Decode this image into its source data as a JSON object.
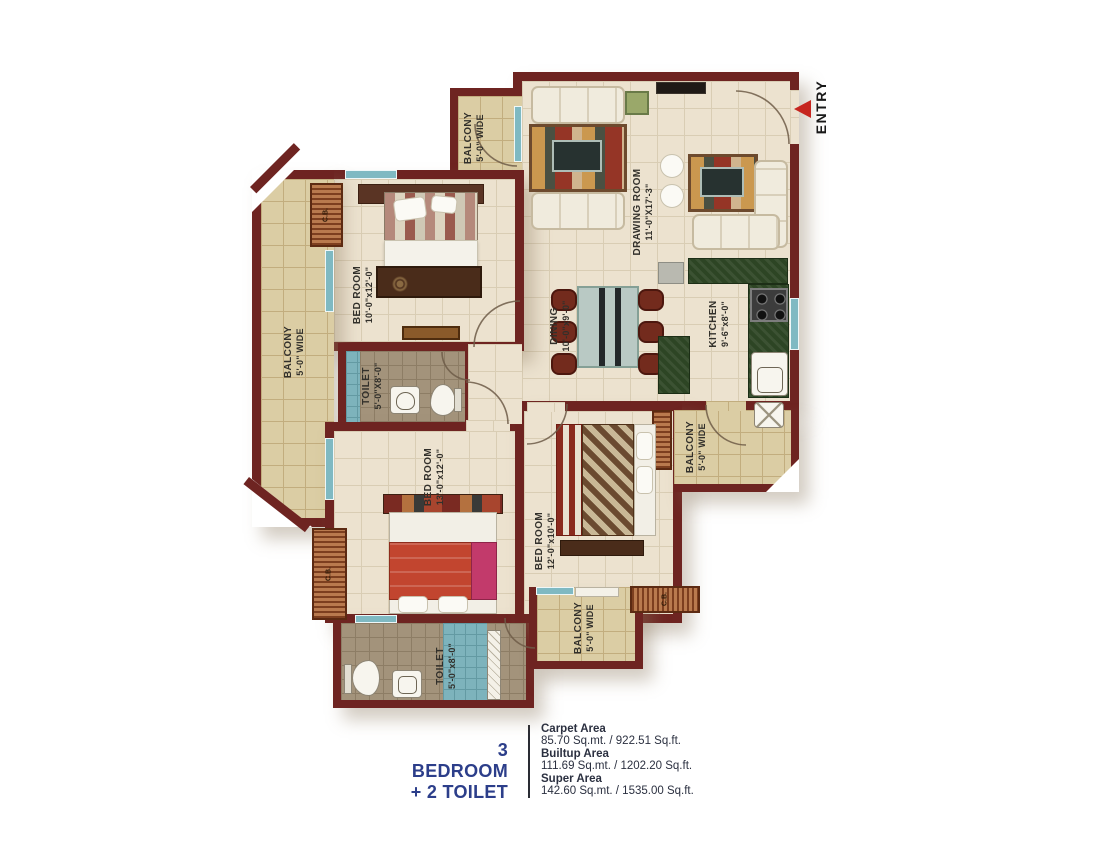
{
  "entry": {
    "label": "ENTRY",
    "arrow_color": "#c6251f"
  },
  "rooms": {
    "drawing": {
      "name": "DRAWING ROOM",
      "size": "11'-0\"X17'-3\""
    },
    "bed1": {
      "name": "BED ROOM",
      "size": "10'-0\"x12'-0\""
    },
    "bed2": {
      "name": "BED ROOM",
      "size": "13'-0\"x12'-0\""
    },
    "bed3": {
      "name": "BED ROOM",
      "size": "12'-0\"x10'-0\""
    },
    "dining": {
      "name": "DINING",
      "size": "10'-0\"x9'-0\""
    },
    "kitchen": {
      "name": "KITCHEN",
      "size": "9'-6\"x8'-0\""
    },
    "toilet1": {
      "name": "TOILET",
      "size": "5'-0\"X8'-0\""
    },
    "toilet2": {
      "name": "TOILET",
      "size": "5'-0\"x8'-0\""
    },
    "balcony_top": {
      "name": "BALCONY",
      "size": "5'-0\" WIDE"
    },
    "balcony_left": {
      "name": "BALCONY",
      "size": "5'-0\" WIDE"
    },
    "balcony_right": {
      "name": "BALCONY",
      "size": "5'-0\" WIDE"
    },
    "balcony_bottom": {
      "name": "BALCONY",
      "size": "5'-0\" WIDE"
    }
  },
  "cb": "C.B.",
  "summary": {
    "title1": "3 BEDROOM",
    "title2": "+ 2 TOILET",
    "areas": [
      {
        "label": "Carpet Area",
        "value": "85.70 Sq.mt. / 922.51 Sq.ft."
      },
      {
        "label": "Builtup Area",
        "value": "111.69 Sq.mt. / 1202.20 Sq.ft."
      },
      {
        "label": "Super Area",
        "value": "142.60 Sq.mt. / 1535.00 Sq.ft."
      }
    ]
  },
  "colors": {
    "wall": "#6e2421",
    "floor": "#ece2cf",
    "balcony_floor": "#dbcda4",
    "toilet_floor": "#a3937b",
    "toilet_blue": "#7db3bc",
    "kitchen_counter": "#2d4524",
    "title_blue": "#2c3e8a",
    "entry_red": "#c6251f"
  }
}
